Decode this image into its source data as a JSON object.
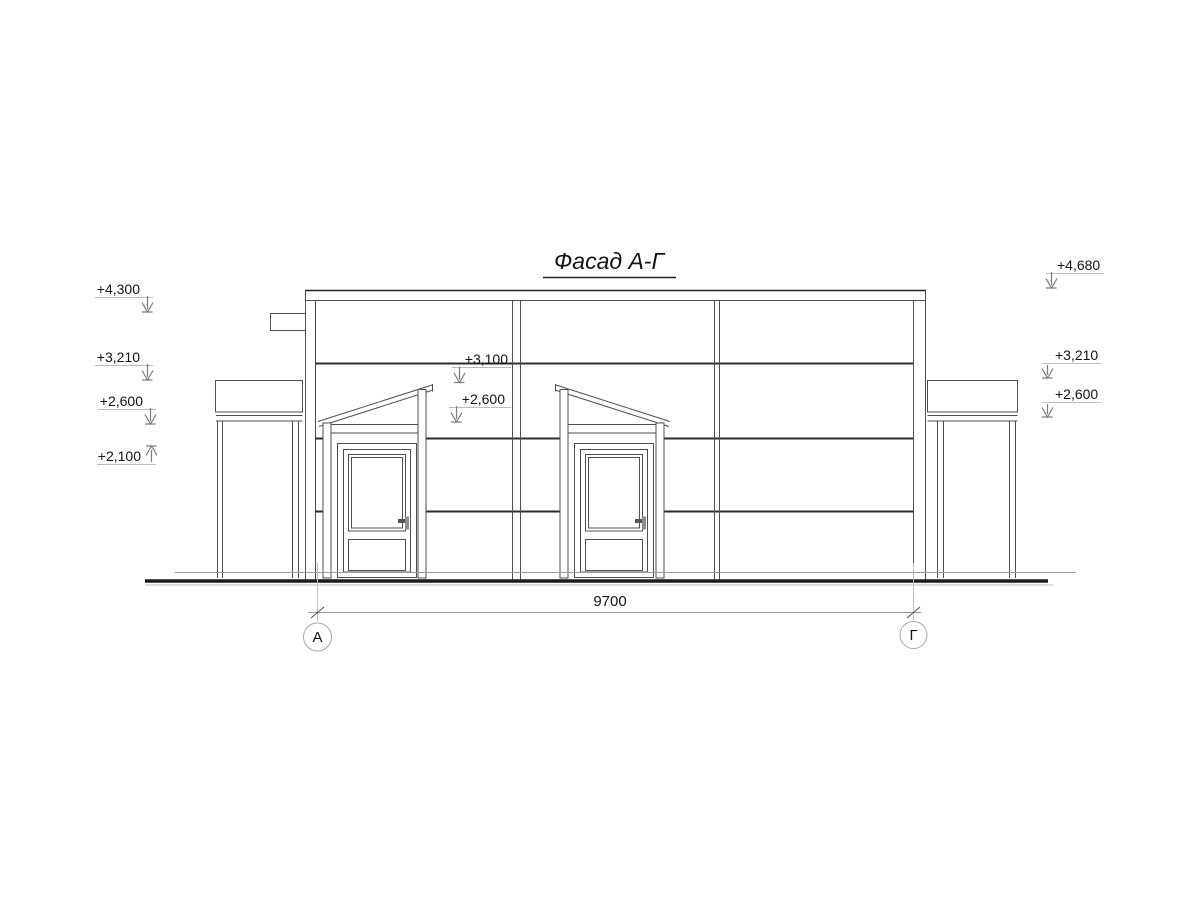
{
  "title": "Фасад А-Г",
  "colors": {
    "background": "#ffffff",
    "line": "#4f4f4f",
    "line_strong": "#2e2e2e",
    "line_light": "#bdbdbd",
    "ground": "#1b1b1b",
    "text": "#141414"
  },
  "elevation_marks": {
    "left": [
      {
        "label": "+4,300",
        "direction": "down"
      },
      {
        "label": "+3,210",
        "direction": "down"
      },
      {
        "label": "+2,600",
        "direction": "down"
      },
      {
        "label": "+2,100",
        "direction": "up"
      }
    ],
    "center": [
      {
        "label": "+3,100",
        "direction": "down"
      },
      {
        "label": "+2,600",
        "direction": "down"
      }
    ],
    "right": [
      {
        "label": "+4,680",
        "direction": "down"
      },
      {
        "label": "+3,210",
        "direction": "down"
      },
      {
        "label": "+2,600",
        "direction": "down"
      }
    ]
  },
  "dimension": {
    "length_label": "9700"
  },
  "axes": {
    "left": "А",
    "right": "Г"
  }
}
